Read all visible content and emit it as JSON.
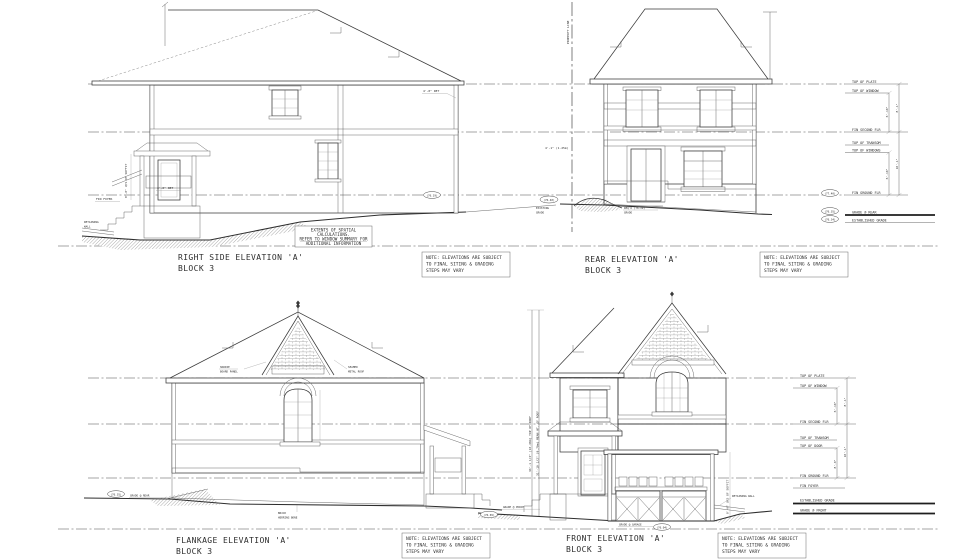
{
  "colors": {
    "ink": "#3a3a3a",
    "paper": "#ffffff"
  },
  "titles": {
    "right_side": {
      "name": "RIGHT SIDE ELEVATION 'A'",
      "block": "BLOCK 3"
    },
    "rear": {
      "name": "REAR ELEVATION 'A'",
      "block": "BLOCK 3"
    },
    "flankage": {
      "name": "FLANKAGE ELEVATION 'A'",
      "block": "BLOCK 3"
    },
    "front": {
      "name": "FRONT ELEVATION 'A'",
      "block": "BLOCK 3"
    }
  },
  "extents_note": {
    "l1": "EXTENTS OF SPATIAL",
    "l2": "CALCULATIONS.",
    "l3": "REFER TO WINDOW SUMMARY FOR",
    "l4": "ADDITIONAL INFORMATION"
  },
  "siting_note": {
    "l1": "NOTE: ELEVATIONS ARE SUBJECT",
    "l2": "TO FINAL SITING & GRADING",
    "l3": "STEPS MAY VARY"
  },
  "levels_top": [
    {
      "label": "TOP OF PLATE"
    },
    {
      "label": "TOP OF WINDOW"
    },
    {
      "label": "FIN SECOND FLR"
    },
    {
      "label": "TOP OF TRANSOM"
    },
    {
      "label": "TOP OF WINDOWS"
    },
    {
      "label": "FIN GROUND FLR",
      "elev": "(77.40)"
    },
    {
      "label": "GRADE @ REAR",
      "elev": "(76.35)"
    },
    {
      "label": "ESTABLISHED GRADE",
      "elev": "(76.34)"
    }
  ],
  "levels_bottom": [
    {
      "label": "TOP OF PLATE"
    },
    {
      "label": "TOP OF WINDOW"
    },
    {
      "label": "FIN SECOND FLR"
    },
    {
      "label": "TOP OF TRANSOM"
    },
    {
      "label": "TOP OF DOOR"
    },
    {
      "label": "FIN GROUND FLR"
    },
    {
      "label": "FIN FOYER"
    },
    {
      "label": "ESTABLISHED GRADE"
    },
    {
      "label": "GRADE @ FRONT"
    }
  ],
  "dims_top": {
    "window_to_floor": "6'-10\"",
    "plate_to_floor": "8'-1\"",
    "window_to_ground": "6'-10\"",
    "floor_to_floor": "10'-1\""
  },
  "dims_bottom": {
    "window_to_floor": "6'-10\"",
    "plate_to_floor": "8'-1\"",
    "door_height": "8'-0\"",
    "floor_to_floor": "10'-1\""
  },
  "annotations": {
    "property_line": "PROPERTY LINE",
    "retaining_1a": "RETAINING",
    "retaining_1b": "WALL",
    "retaining_2": "RETAINING WALL",
    "fin_foyer": "FIN FOYER",
    "ret_a": "4'-0\" RET",
    "ret_b": "4'-0\" RET",
    "rear_offset": "4'-1\" (1.25m)",
    "soffit_a": "8'-0\" U/S OF SOFFIT",
    "soffit_b": "8'-0\" U/S OF SOFFIT",
    "hardie_1": "HARDIE",
    "hardie_2": "BOARD PANEL",
    "seamed_1": "SEAMED",
    "seamed_2": "METAL ROOF",
    "herring_1": "BRICK",
    "herring_2": "HERRING BONE",
    "top_of_roof": "34'-1 1/2\" (10.40m) TOP OF ROOF",
    "mean_roof": "31'-10 1/2\" (9.70m) MEAN HT. OF ROOF"
  },
  "grades": {
    "g_76_84": "(76.84)",
    "g_76_19": "(76.19)",
    "existing_elev": "(76.40)",
    "existing_l1": "EXISTING",
    "existing_l2": "GRADE",
    "reqd_l1": "REQ'D (76.19)",
    "reqd_l2": "GRADE",
    "flankage_rear_elev": "(76.35)",
    "flankage_rear_label": "GRADE @ REAR",
    "porch_elev": "(76.65)",
    "porch_label": "GRADE @ PORCH",
    "garage_elev": "(76.04)",
    "garage_label": "GRADE @ GARAGE"
  }
}
